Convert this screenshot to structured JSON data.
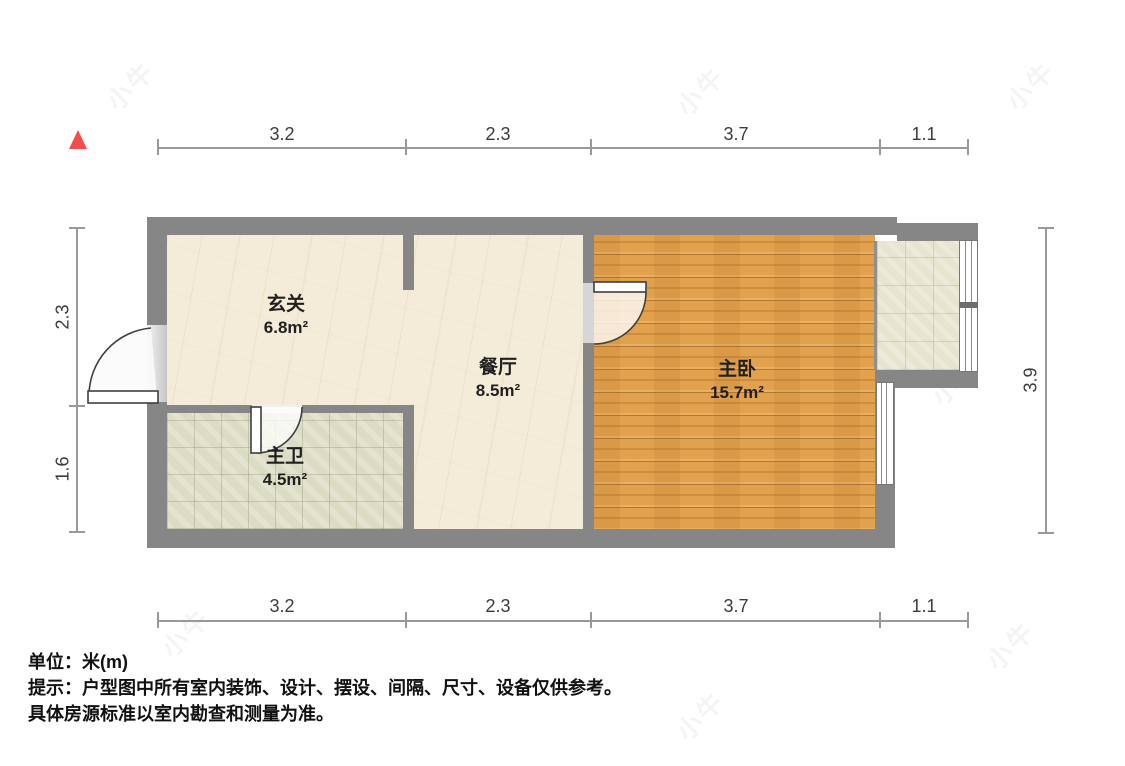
{
  "plan": {
    "type": "residential-floor-plan",
    "unit_label": "米(m)"
  },
  "dims": {
    "top": [
      "3.2",
      "2.3",
      "3.7",
      "1.1"
    ],
    "bottom": [
      "3.2",
      "2.3",
      "3.7",
      "1.1"
    ],
    "left": [
      "2.3",
      "1.6"
    ],
    "right": [
      "3.9"
    ]
  },
  "rooms": {
    "entry": {
      "name": "玄关",
      "area": "6.8m²"
    },
    "dining": {
      "name": "餐厅",
      "area": "8.5m²"
    },
    "bedroom": {
      "name": "主卧",
      "area": "15.7m²"
    },
    "bathroom": {
      "name": "主卫",
      "area": "4.5m²"
    }
  },
  "footer": {
    "unit": "单位：米(m)",
    "tip": "提示：户型图中所有室内装饰、设计、摆设、间隔、尺寸、设备仅供参考。",
    "note": "具体房源标准以室内勘查和测量为准。"
  },
  "watermark": {
    "text": "小牛"
  },
  "colors": {
    "north_arrow": "#ef4e4c",
    "wall": "#868686",
    "wood_floor": "#e2a14c",
    "marble_floor": "#f4ecd9",
    "bathroom_tile": "#dcdcc4",
    "balcony_tile": "#e7e4cf",
    "dimension_line": "#999999",
    "text": "#111111"
  }
}
